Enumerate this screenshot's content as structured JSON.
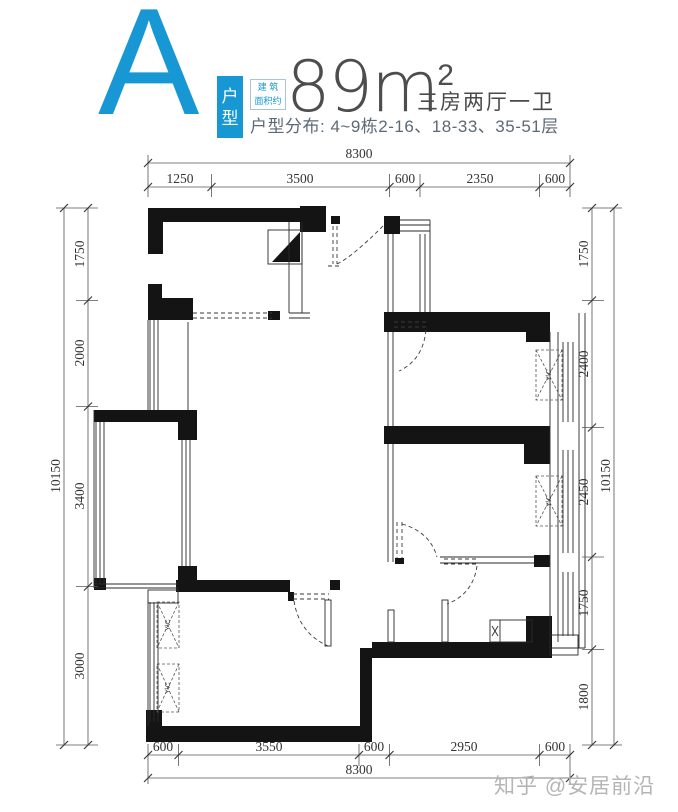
{
  "header": {
    "type_letter": "A",
    "type_tag": {
      "line1": "户",
      "line2": "型"
    },
    "area_tag": {
      "line1": "建 筑",
      "line2": "面积约"
    },
    "area_value": "89m",
    "area_exponent": "2",
    "layout_desc": "三房两厅一卫",
    "distribution": "户型分布: 4~9栋2-16、18-33、35-51层"
  },
  "plan": {
    "ac_unit_label": "Y\\C",
    "dims": {
      "top": {
        "total": "8300",
        "segments": [
          "1250",
          "3500",
          "600",
          "2350",
          "600"
        ]
      },
      "bottom": {
        "total": "8300",
        "segments": [
          "600",
          "3550",
          "600",
          "2950",
          "600"
        ]
      },
      "left": {
        "total": "10150",
        "segments": [
          "1750",
          "2000",
          "3400",
          "3000"
        ]
      },
      "right": {
        "total": "10150",
        "segments": [
          "1750",
          "2400",
          "2450",
          "1750",
          "1800"
        ]
      }
    }
  },
  "watermark": {
    "text": "知乎 @安居前沿"
  },
  "colors": {
    "accent": "#1797d4",
    "wall": "#141414",
    "dim_line": "#555555"
  }
}
